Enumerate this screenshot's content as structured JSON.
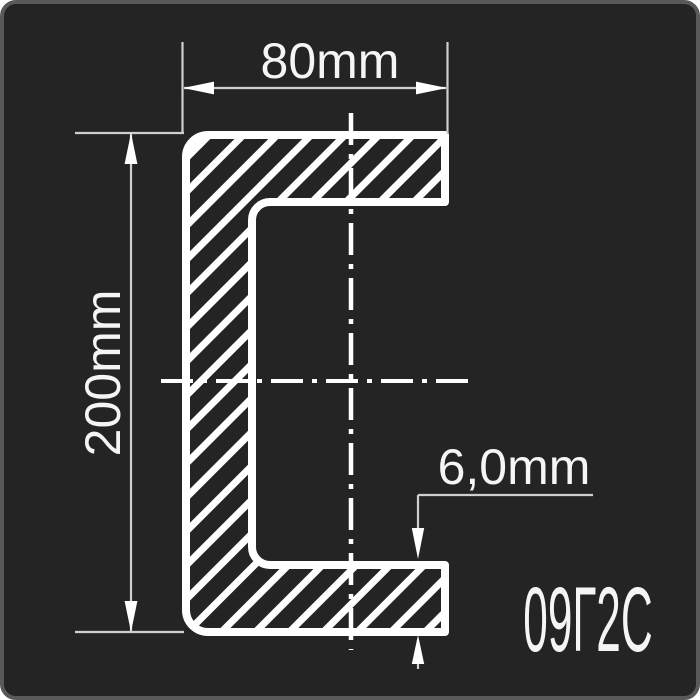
{
  "drawing": {
    "subject": "channel-steel-cross-section",
    "steel_grade_label": "09Г2С",
    "dimensions": {
      "width": {
        "label": "80mm",
        "value_mm": 80
      },
      "height": {
        "label": "200mm",
        "value_mm": 200
      },
      "thickness": {
        "label": "6,0mm",
        "value_mm": 6
      }
    },
    "colors": {
      "page_background": "#ffffff",
      "panel_background": "#242424",
      "panel_border": "#595959",
      "profile_line": "#ffffff",
      "dimension_line": "#cfcfcf",
      "label_text": "#f5f5f5"
    }
  }
}
